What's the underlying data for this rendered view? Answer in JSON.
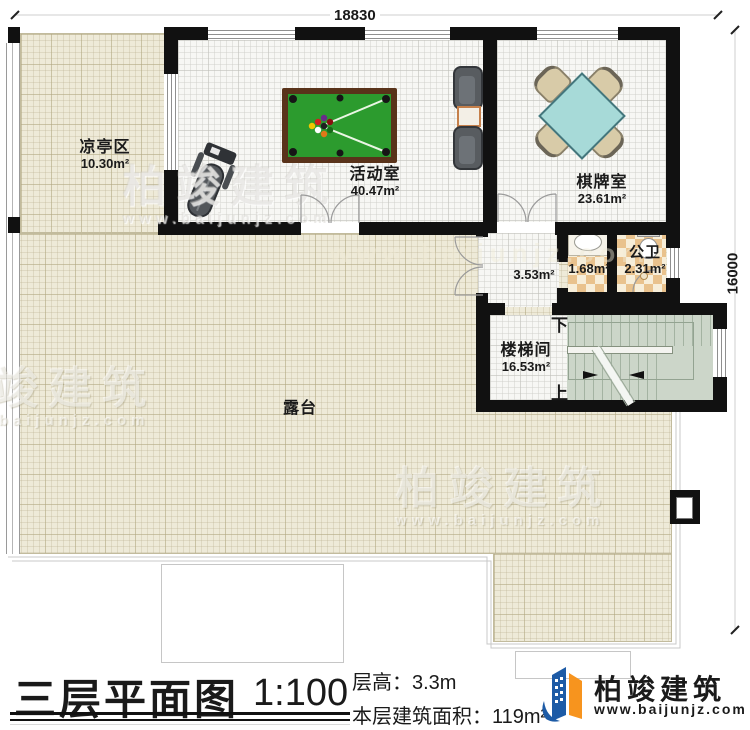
{
  "plan": {
    "dimensions": {
      "top": "18830",
      "right": "16000"
    },
    "rooms": {
      "pavilion": {
        "name": "凉亭区",
        "area": "10.30m²"
      },
      "activity": {
        "name": "活动室",
        "area": "40.47m²"
      },
      "chess": {
        "name": "棋牌室",
        "area": "23.61m²"
      },
      "hall": {
        "area": "3.53m²"
      },
      "wash": {
        "area": "1.68m²"
      },
      "wc": {
        "name": "公卫",
        "area": "2.31m²"
      },
      "stairwell": {
        "name": "楼梯间",
        "area": "16.53m²"
      },
      "terrace": {
        "name": "露台"
      }
    },
    "stairs": {
      "down": "下",
      "up": "上"
    }
  },
  "titleblock": {
    "title": "三层平面图",
    "scale": "1:100",
    "floor_height": "层高：3.3m",
    "floor_area": "本层建筑面积：119m²"
  },
  "brand": {
    "name": "柏竣建筑",
    "site": "www.baijunjz.com"
  },
  "watermark": {
    "name": "柏竣建筑",
    "site": "www.baijunjz.com"
  },
  "colors": {
    "wall": "#111111",
    "terrace": "#eeead8",
    "floor": "#f6f6f3",
    "stair": "#ccd6c9",
    "tile_a": "#e9c28d",
    "tile_b": "#f7eed9",
    "pool_felt": "#2c9b2e",
    "pool_rim": "#59331a",
    "table_teal": "#a7dad8",
    "brand_blue": "#1d5ba6",
    "brand_orange": "#f7941e"
  }
}
